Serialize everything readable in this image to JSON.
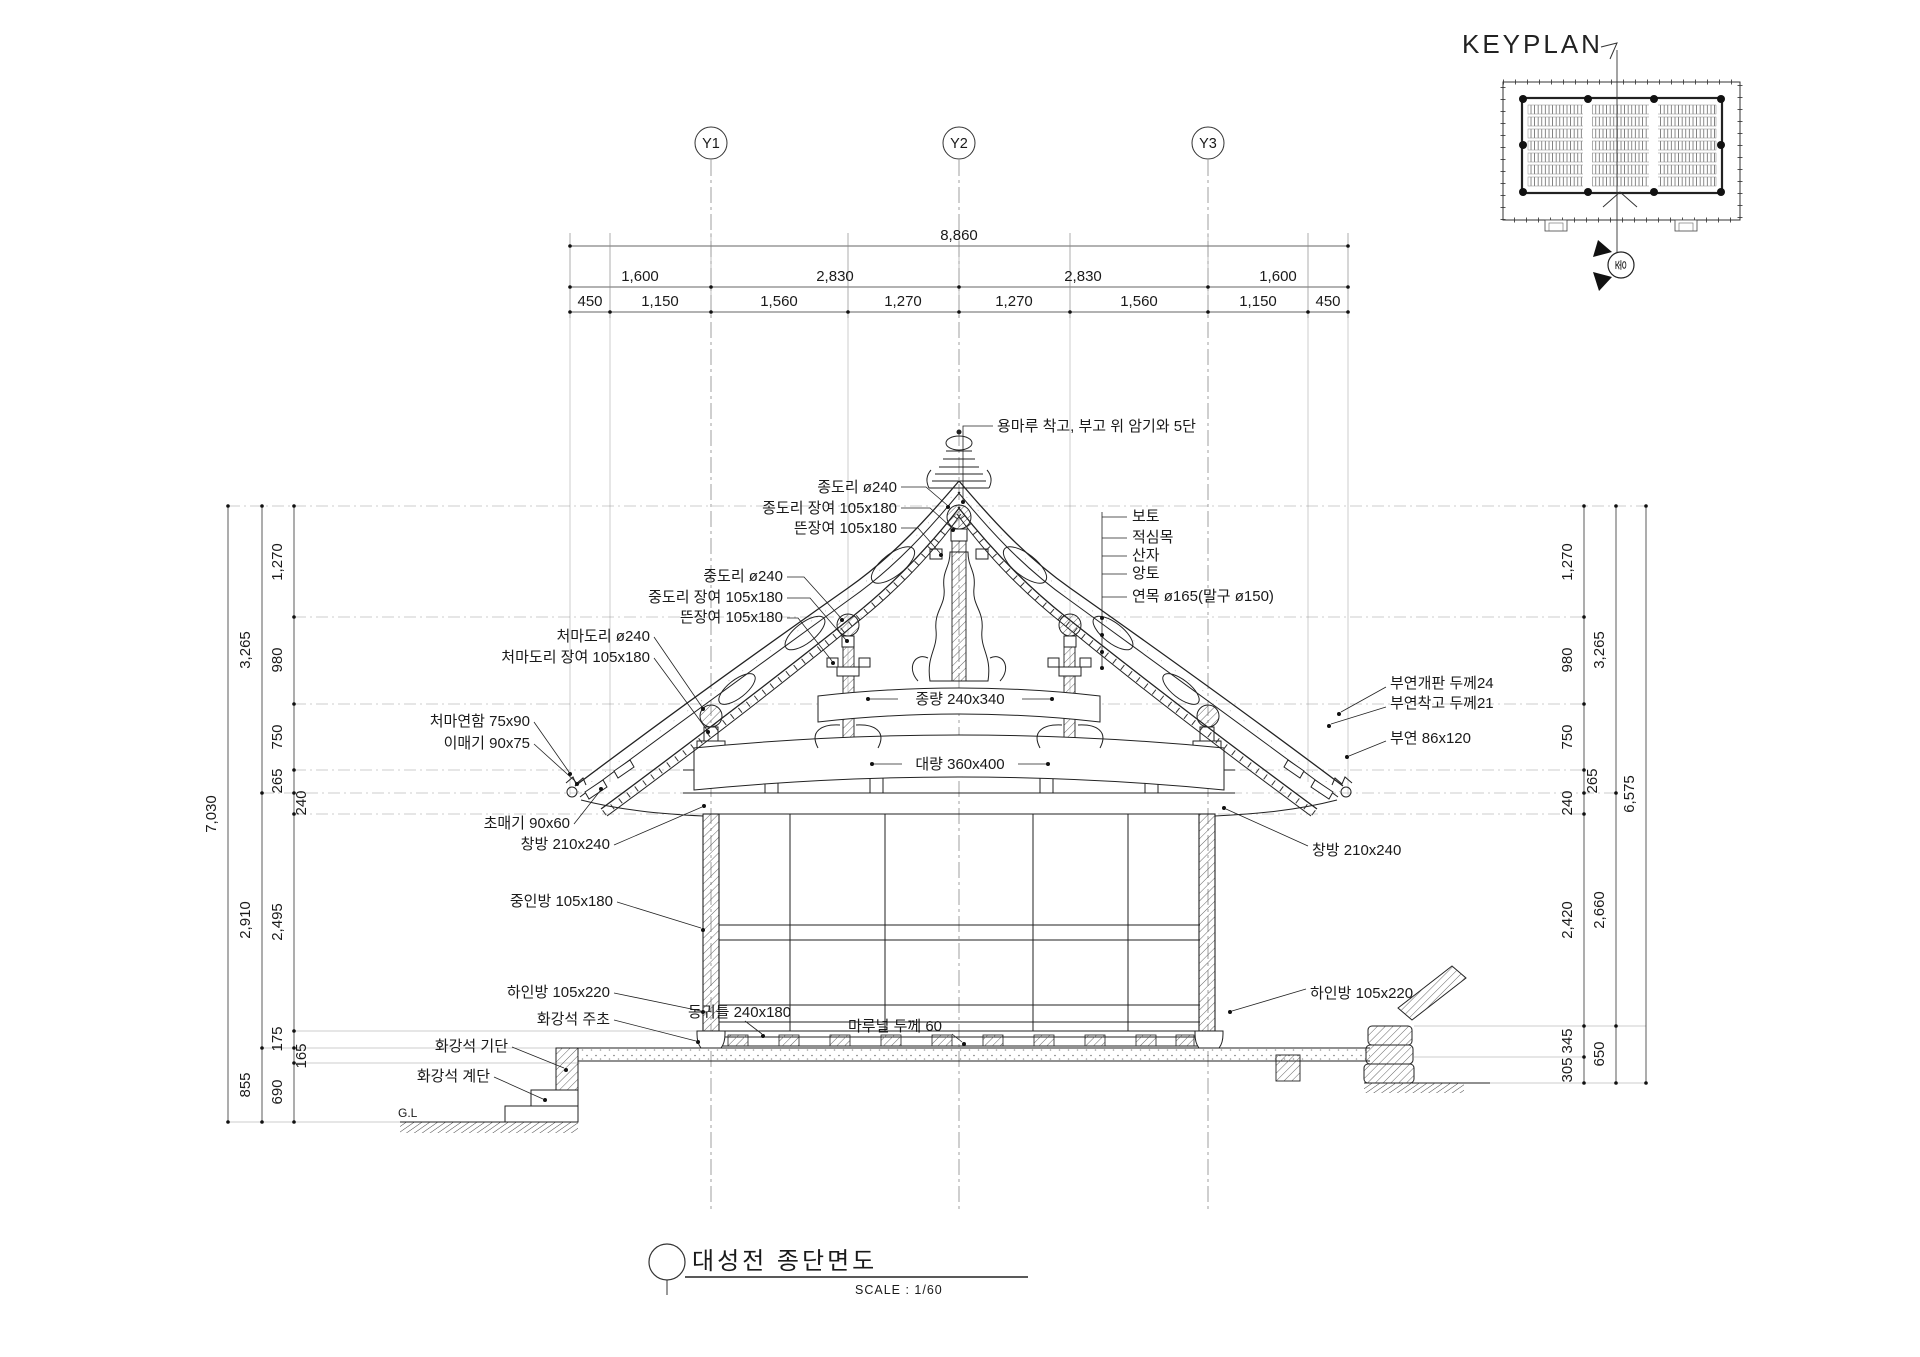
{
  "drawing_title": {
    "text": "대성전 종단면도",
    "scale": "SCALE : 1/60"
  },
  "keyplan": {
    "title": "KEYPLAN",
    "section_mark": "종"
  },
  "grid_bubbles": [
    "Y1",
    "Y2",
    "Y3"
  ],
  "top_dims": {
    "total": "8,860",
    "spans": [
      "1,600",
      "2,830",
      "2,830",
      "1,600"
    ],
    "subspans": [
      "450",
      "1,150",
      "1,560",
      "1,270",
      "1,270",
      "1,560",
      "1,150",
      "450"
    ]
  },
  "left_dims": {
    "total": "7,030",
    "mid": [
      "3,265",
      "2,910",
      "855"
    ],
    "inner": [
      "1,270",
      "980",
      "750",
      "265",
      "240",
      "2,495",
      "175",
      "165",
      "690"
    ]
  },
  "right_dims": {
    "total": "6,575",
    "mid": [
      "3,265",
      "2,660",
      "650"
    ],
    "inner": [
      "1,270",
      "980",
      "750",
      "265",
      "240",
      "2,420",
      "345",
      "305"
    ]
  },
  "callouts": {
    "yongmaru": "용마루 착고, 부고 위 암기와 5단",
    "jongdori": "종도리 ø240",
    "jongdori_jangyeo": "종도리 장여 105x180",
    "tteunjangyeo1": "뜬장여 105x180",
    "jungdori": "중도리 ø240",
    "jungdori_jangyeo": "중도리 장여 105x180",
    "tteunjangyeo2": "뜬장여 105x180",
    "cheomadori": "처마도리 ø240",
    "cheomadori_jangyeo": "처마도리 장여 105x180",
    "cheomayeonham": "처마연함 75x90",
    "imaegi": "이매기 90x75",
    "chomaegi": "초매기 90x60",
    "changbang_left": "창방 210x240",
    "junginbang": "중인방 105x180",
    "hainbang_left": "하인방 105x220",
    "jucho": "화강석 주초",
    "gidan": "화강석 기단",
    "gyedan": "화강석 계단",
    "ground_level": "G.L",
    "boto": "보토",
    "jeoksimmok": "적심목",
    "sanja": "산자",
    "angto": "앙토",
    "yeonmok": "연목 ø165(말구 ø150)",
    "buyeon_gaepan": "부연개판 두께24",
    "buyeon_chakgo": "부연착고 두께21",
    "buyeon": "부연 86x120",
    "changbang_right": "창방 210x240",
    "hainbang_right": "하인방 105x220",
    "jongryang": "종량 240x340",
    "daeryang": "대량 360x400",
    "donggwiteul": "동귀틀 240x180",
    "maruneol": "마루널 두께 60"
  }
}
